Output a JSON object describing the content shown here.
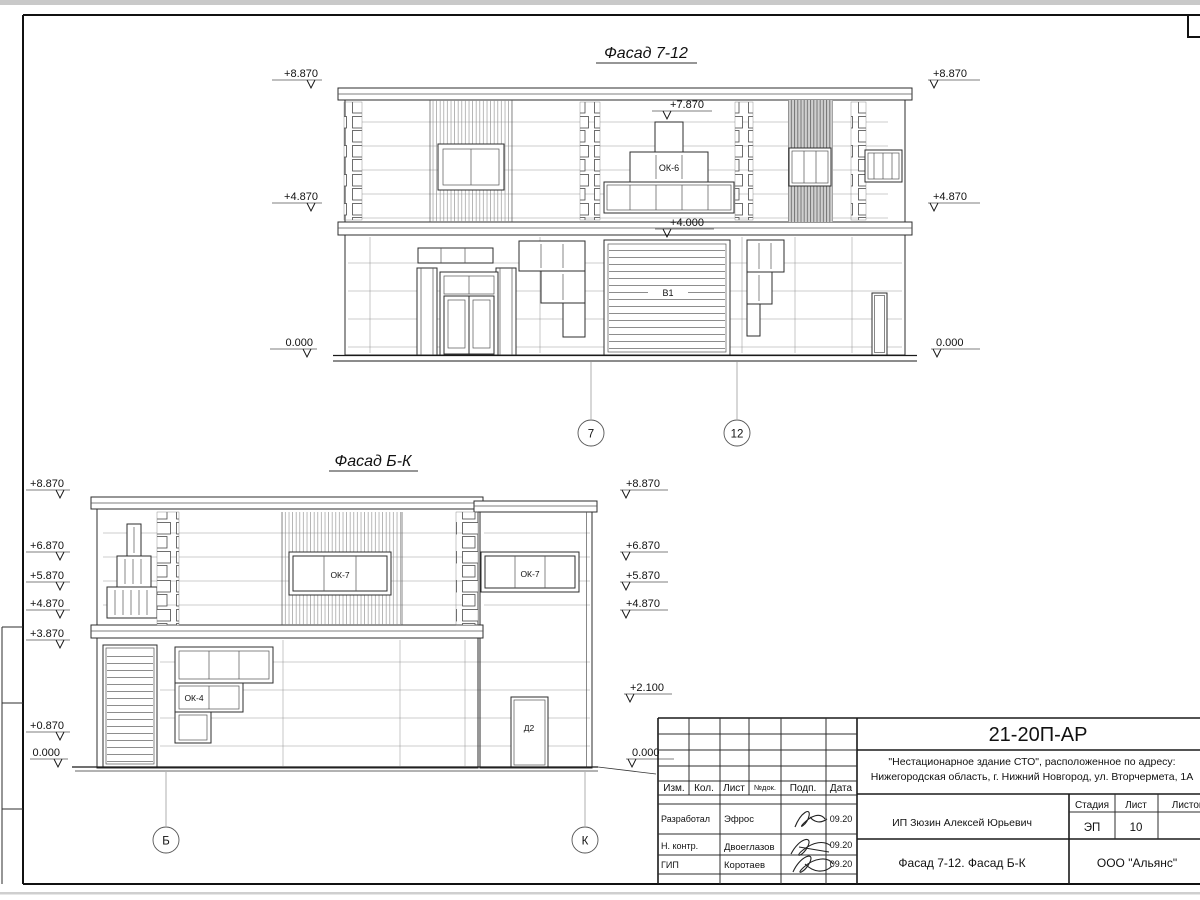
{
  "sheet": {
    "facade_top": {
      "title": "Фасад 7-12",
      "marks_left": [
        "+8.870",
        "+4.870",
        "0.000"
      ],
      "marks_right": [
        "+8.870",
        "+4.870",
        "0.000"
      ],
      "mark_window_top": "+7.870",
      "mark_gate_top": "+4.000",
      "window_group_label": "ОК-6",
      "gate_label": "В1",
      "axis_markers": [
        "7",
        "12"
      ]
    },
    "facade_bottom": {
      "title": "Фасад Б-К",
      "marks_left": [
        "+8.870",
        "+6.870",
        "+5.870",
        "+4.870",
        "+3.870",
        "+0.870",
        "0.000"
      ],
      "marks_right": [
        "+8.870",
        "+6.870",
        "+5.870",
        "+4.870",
        "+2.100",
        "0.000"
      ],
      "window_label_1": "ОК-7",
      "window_label_2": "ОК-7",
      "window_label_3": "ОК-4",
      "door_label": "Д2",
      "axis_markers": [
        "Б",
        "К"
      ]
    }
  },
  "title_block": {
    "doc_number": "21-20П-АР",
    "description_line1": "\"Нестационарное здание СТО\", расположенное по адресу:",
    "description_line2": "Нижегородская область, г. Нижний Новгород, ул. Вторчермета, 1А",
    "col_izm": "Изм.",
    "col_kol": "Кол.",
    "col_list": "Лист",
    "col_ndoc": "№док.",
    "col_podp": "Подп.",
    "col_data": "Дата",
    "row1_role": "Разработал",
    "row1_name": "Эфрос",
    "row1_date": "09.20",
    "row2_role": "Н. контр.",
    "row2_name": "Двоеглазов",
    "row2_date": "09.20",
    "row3_role": "ГИП",
    "row3_name": "Коротаев",
    "row3_date": "09.20",
    "client": "ИП Зюзин Алексей Юрьевич",
    "stage_label": "Стадия",
    "sheet_label": "Лист",
    "sheets_label": "Листов",
    "stage_value": "ЭП",
    "sheet_value": "10",
    "sheet_title": "Фасад 7-12. Фасад Б-К",
    "company": "ООО \"Альянс\""
  }
}
